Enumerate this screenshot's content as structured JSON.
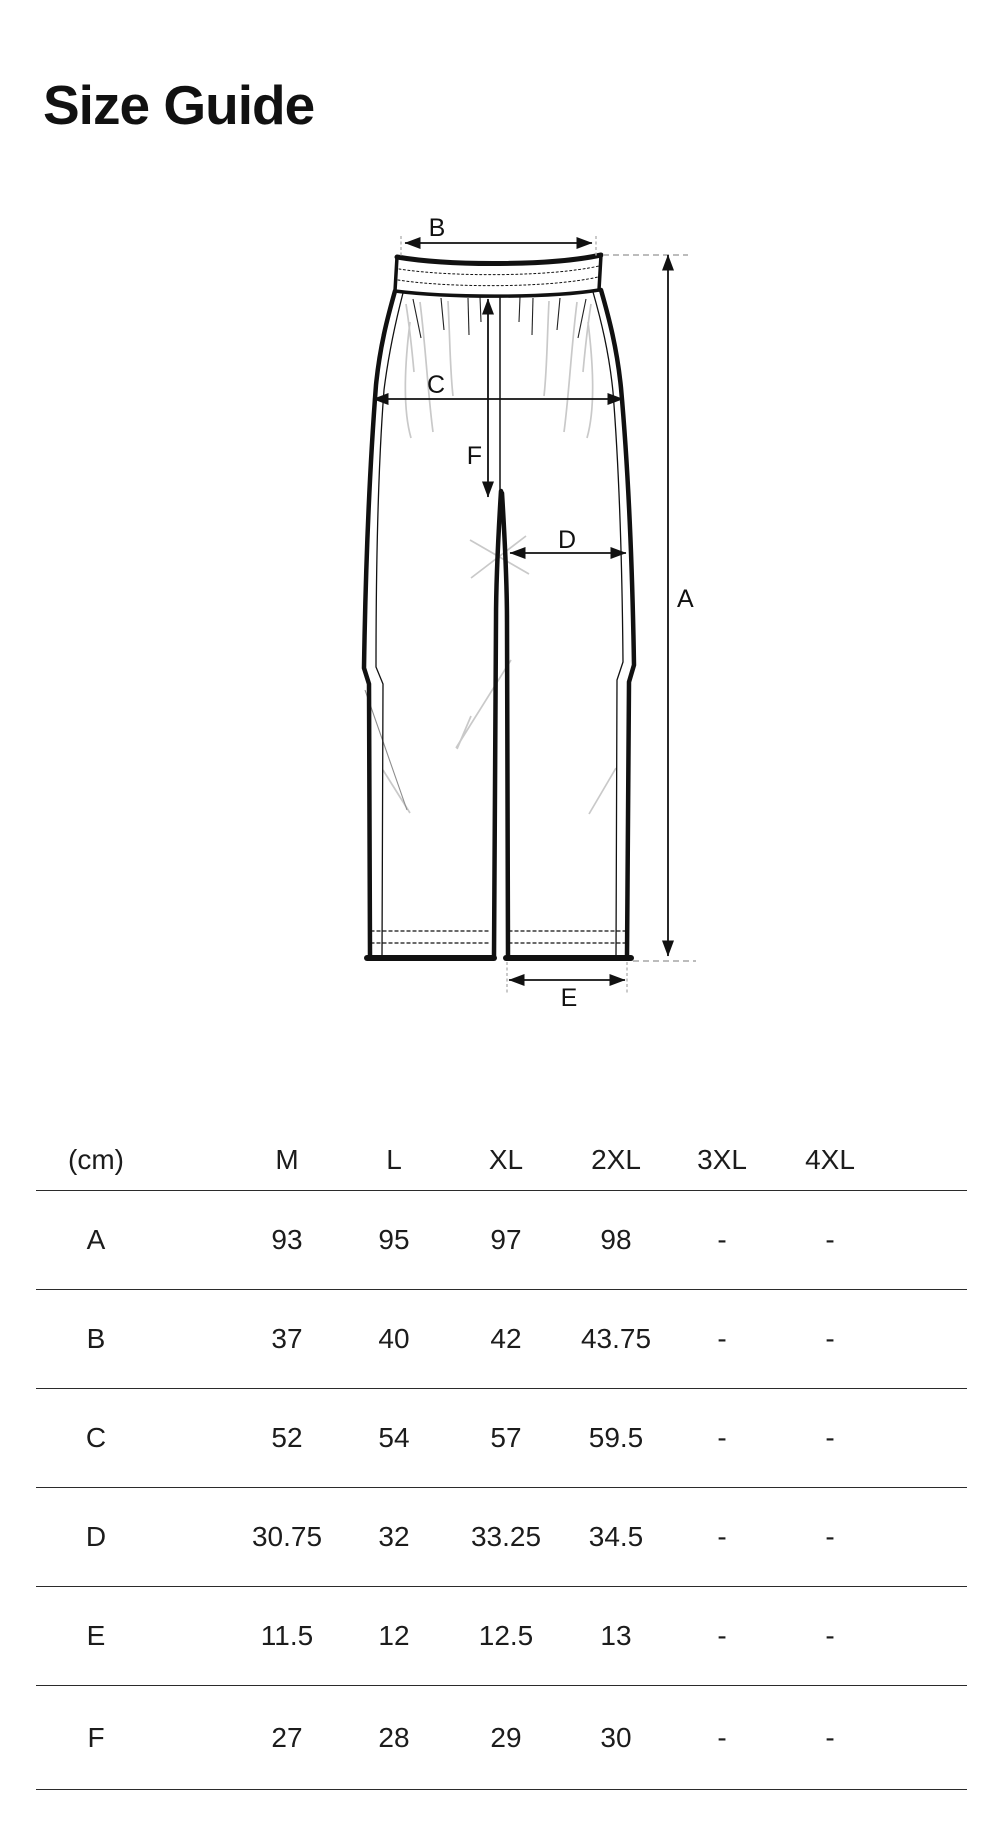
{
  "page": {
    "title": "Size Guide"
  },
  "diagram": {
    "description": "front view of wide-leg pants with elastic waistband and measurement arrows",
    "labels": {
      "a": "A",
      "b": "B",
      "c": "C",
      "d": "D",
      "e": "E",
      "f": "F"
    }
  },
  "table": {
    "unit_header": "(cm)",
    "columns": [
      "M",
      "L",
      "XL",
      "2XL",
      "3XL",
      "4XL"
    ],
    "rows": [
      {
        "label": "A",
        "values": [
          "93",
          "95",
          "97",
          "98",
          "-",
          "-"
        ]
      },
      {
        "label": "B",
        "values": [
          "37",
          "40",
          "42",
          "43.75",
          "-",
          "-"
        ]
      },
      {
        "label": "C",
        "values": [
          "52",
          "54",
          "57",
          "59.5",
          "-",
          "-"
        ]
      },
      {
        "label": "D",
        "values": [
          "30.75",
          "32",
          "33.25",
          "34.5",
          "-",
          "-"
        ]
      },
      {
        "label": "E",
        "values": [
          "11.5",
          "12",
          "12.5",
          "13",
          "-",
          "-"
        ]
      },
      {
        "label": "F",
        "values": [
          "27",
          "28",
          "29",
          "30",
          "-",
          "-"
        ]
      }
    ]
  },
  "colors": {
    "ink": "#111111",
    "table_line": "#2b2b2b",
    "guide_dash": "#b3b3b3",
    "crease": "#c9c9c9"
  }
}
